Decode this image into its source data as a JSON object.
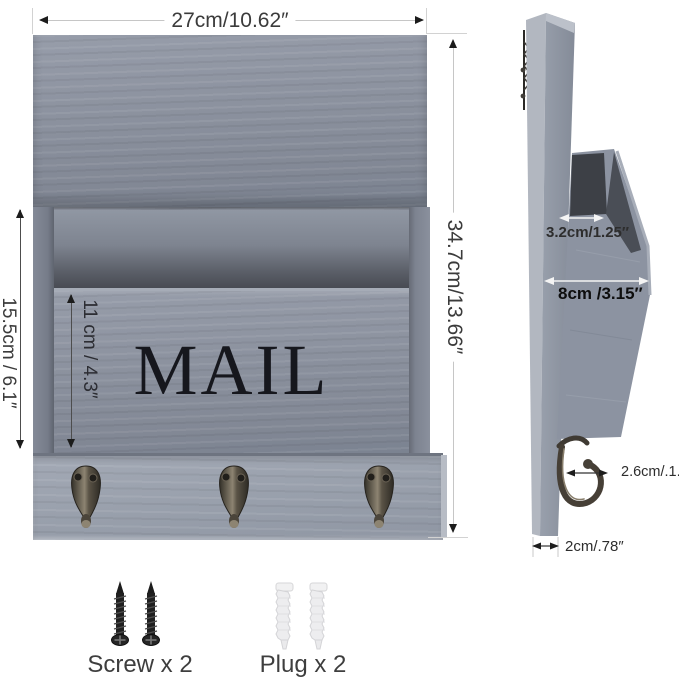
{
  "front_view": {
    "width_label": "27cm/10.62″",
    "height_label": "34.7cm/13.66″",
    "pocket_height_label": "15.5cm / 6.1″",
    "inner_height_label": "11 cm / 4.3″",
    "mail_text": "MAIL"
  },
  "side_view": {
    "slot_width_label": "3.2cm/1.25″",
    "depth_label": "8cm /3.15″",
    "hook_depth_label": "2.6cm/.1.02″",
    "thickness_label": "2cm/.78″"
  },
  "hardware": {
    "screws_label": "Screw x 2",
    "plugs_label": "Plug x 2"
  },
  "colors": {
    "wood_gray": "#8b919e",
    "wood_gray_light": "#99a0ac",
    "interior_shadow": "#484b53",
    "hook_metal": "#46403a",
    "dimension_line": "#c6c6c6",
    "text": "#3b3b3b"
  }
}
